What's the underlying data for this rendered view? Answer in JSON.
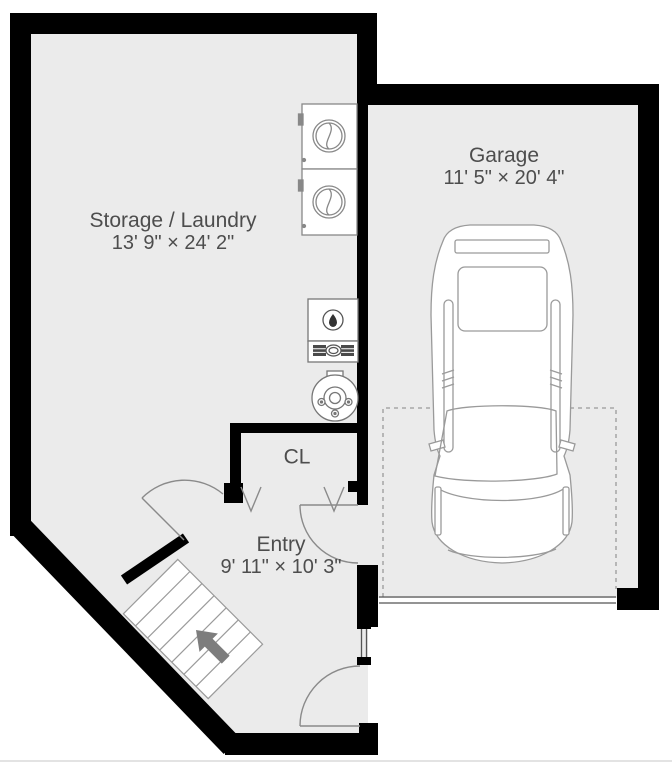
{
  "rooms": {
    "storage_laundry": {
      "name": "Storage / Laundry",
      "dims": "13' 9\" × 24' 2\""
    },
    "garage": {
      "name": "Garage",
      "dims": "11' 5\" × 20' 4\""
    },
    "entry": {
      "name": "Entry",
      "dims": "9' 11\" × 10' 3\""
    },
    "closet": {
      "abbr": "CL"
    }
  },
  "fixtures": {
    "washer": "washer-icon",
    "dryer": "dryer-icon",
    "furnace": "furnace-icon",
    "water_heater": "water-heater-icon",
    "car": "car-icon",
    "stairs": "staircase-icon",
    "stairs_arrow": "stairs-direction-arrow"
  },
  "colors": {
    "wall": "#000000",
    "floor": "#ebebeb",
    "background": "#ffffff",
    "fixture_line": "#8a8a8a",
    "text": "#4d4d4d",
    "arrow": "#7d7d7d"
  }
}
